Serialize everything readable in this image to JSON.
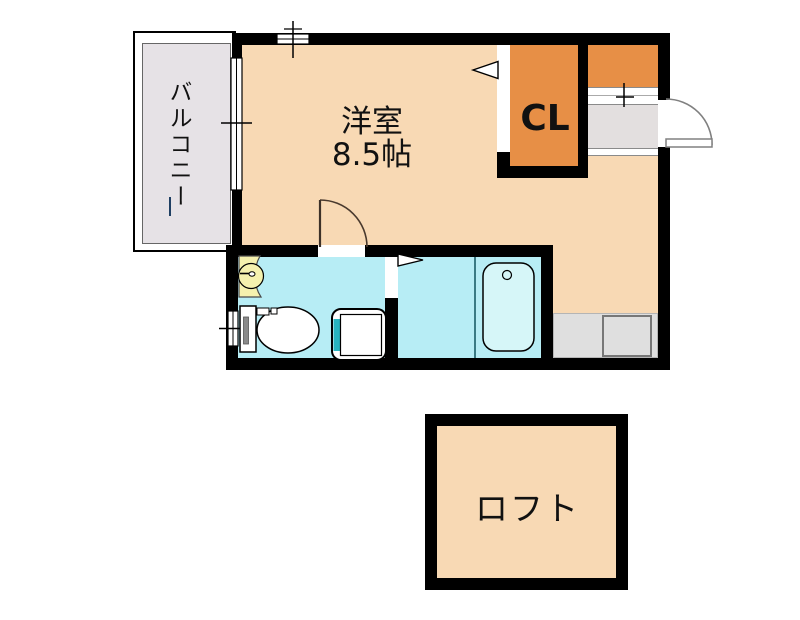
{
  "floorplan": {
    "rooms": {
      "balcony": {
        "label": "バルコニー"
      },
      "main": {
        "label": "洋室",
        "size": "8.5帖"
      },
      "closet": {
        "label": "CL"
      },
      "loft": {
        "label": "ロフト"
      }
    },
    "colors": {
      "wall": "#000000",
      "room_fill": "#f8d9b4",
      "closet_fill": "#e78f46",
      "wet_room_fill": "#b7edf5",
      "bathtub_fill": "#d6f6f8",
      "balcony_fill": "#e6e2e6",
      "entry_floor_fill": "#e3dfdf",
      "counter_fill": "#dfdfdf",
      "basin_fill": "#f5f1ae",
      "washer_accent": "#28b4c0"
    }
  }
}
